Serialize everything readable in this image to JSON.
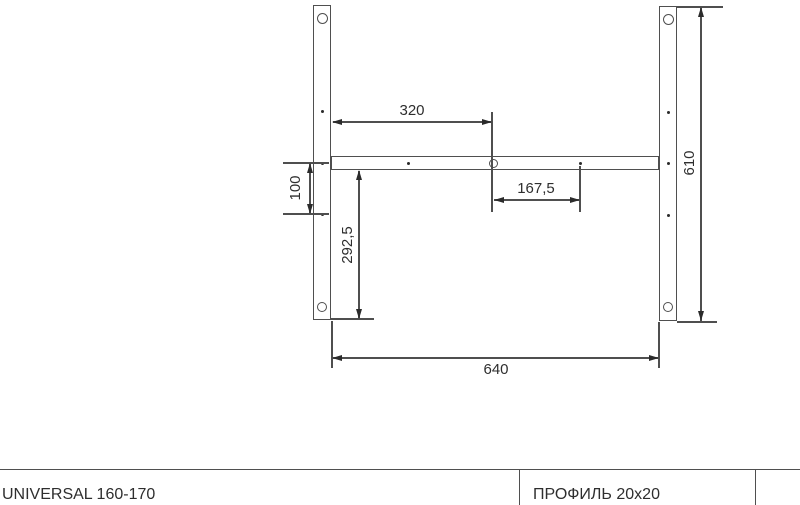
{
  "drawing": {
    "dim_top_span": "320",
    "dim_hole_offset": "167,5",
    "dim_left_drop": "100",
    "dim_lower_drop": "292,5",
    "dim_overall_width": "640",
    "dim_overall_height": "610"
  },
  "footer": {
    "model_label": "UNIVERSAL 160-170",
    "profile_label": "ПРОФИЛЬ 20x20"
  },
  "colors": {
    "background": "#ffffff",
    "line": "#4f4f4f",
    "arrow": "#2b2b2b",
    "text": "#2e2e2e"
  }
}
